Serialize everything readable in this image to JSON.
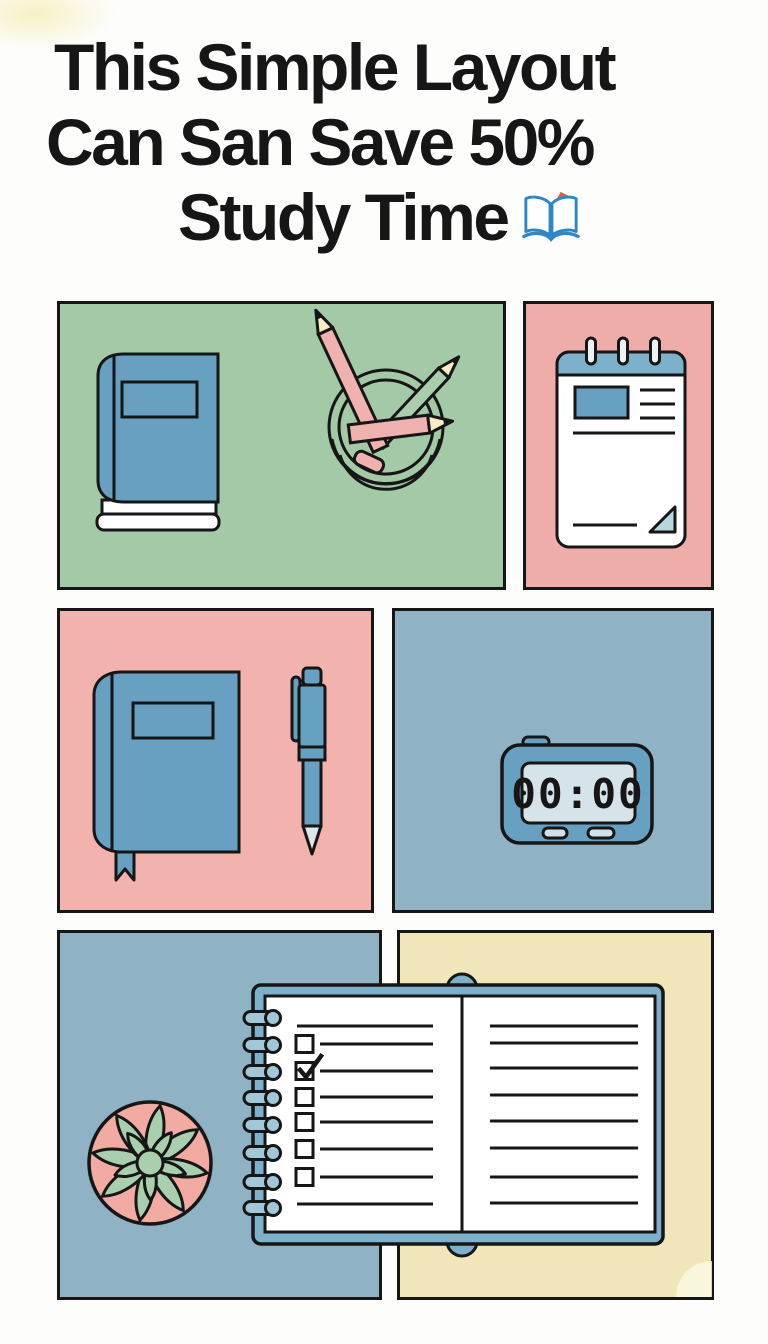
{
  "title": {
    "line1": "This Simple Layout",
    "line2": "Can San Save 50%",
    "line3": "Study Time",
    "emoji": "open-book-with-bookmark"
  },
  "timer": {
    "display": "00:00"
  },
  "panels": [
    {
      "id": "book-and-pencil-cup",
      "background": "green",
      "contents": [
        "closed blue book",
        "pencil cup with three pencils"
      ]
    },
    {
      "id": "notepad",
      "background": "pink",
      "contents": [
        "ring-bound notepad with photo block, text lines, folded corner"
      ]
    },
    {
      "id": "journal-and-pen",
      "background": "pink",
      "contents": [
        "blue journal with bookmark ribbon",
        "pen"
      ]
    },
    {
      "id": "digital-timer",
      "background": "blue",
      "contents": [
        "digital timer showing 00:00"
      ]
    },
    {
      "id": "succulent",
      "background": "blue",
      "contents": [
        "potted succulent, top view"
      ]
    },
    {
      "id": "open-notebook-bg",
      "background": "cream",
      "contents": [
        "backdrop for open notebook"
      ]
    }
  ],
  "notebook": {
    "ring_count": 8,
    "left_page_rows": [
      {
        "type": "line"
      },
      {
        "type": "checkbox",
        "checked": false
      },
      {
        "type": "checkbox",
        "checked": true
      },
      {
        "type": "checkbox",
        "checked": false
      },
      {
        "type": "checkbox",
        "checked": false
      },
      {
        "type": "checkbox",
        "checked": false
      },
      {
        "type": "checkbox",
        "checked": false
      },
      {
        "type": "line"
      }
    ],
    "right_page_line_count": 8
  },
  "colors": {
    "ink": "#161616",
    "green": "#a4c9a7",
    "pink": "#efada9",
    "pink2": "#f2b2ad",
    "blue": "#8fb2c5",
    "cream": "#f0e6b9",
    "item-blue": "#67a0c0",
    "cover-blue": "#7db0ca",
    "ring-blue": "#a3c7d7",
    "screen": "#d6e4ea",
    "pill": "#cfe0e8",
    "pencil-pink": "#f0b2ae",
    "pencil-green": "#a9cdad",
    "tip-cream": "#f7ecc3",
    "leaf-green": "#a9cfae",
    "pot-pink": "#f2aba2",
    "fold-blue": "#b7d7dc",
    "pen-tip": "#dce7ea",
    "emoji-blue": "#2e86c4",
    "emoji-red": "#e8574b"
  }
}
